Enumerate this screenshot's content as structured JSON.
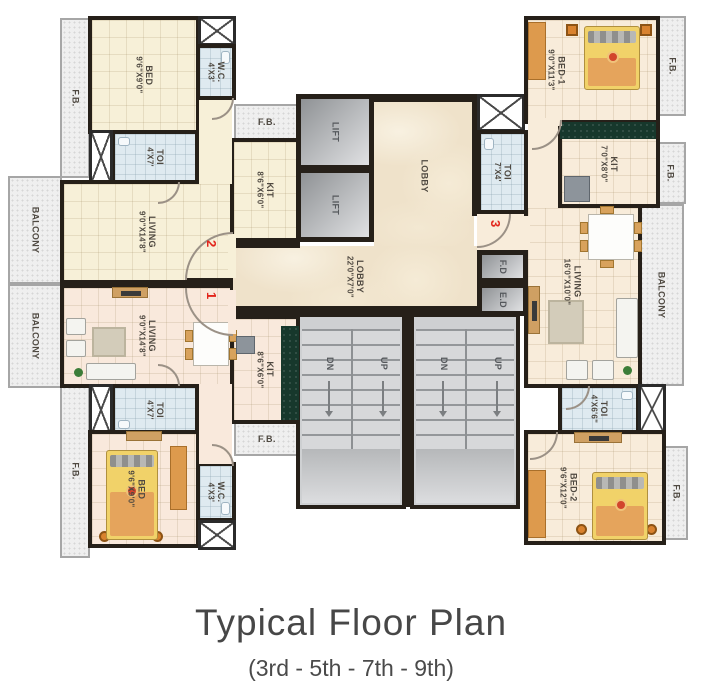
{
  "title": "Typical Floor Plan",
  "subtitle": "(3rd - 5th - 7th - 9th)",
  "fb_label": "F.B.",
  "stair": {
    "dn": "DN",
    "up": "UP"
  },
  "units": {
    "u1": "1",
    "u2": "2",
    "u3": "3"
  },
  "rooms": {
    "bed_tl": {
      "name": "BED",
      "dims": "9'6\"X9'0\""
    },
    "wc_tl": {
      "name": "W.C.",
      "dims": "4'X3'"
    },
    "toi_tl": {
      "name": "TOI",
      "dims": "4'X7'"
    },
    "kit_tl": {
      "name": "KIT",
      "dims": "8'6\"X6'0\""
    },
    "living_tl": {
      "name": "LIVING",
      "dims": "9'0\"X14'8\""
    },
    "balcony_t": {
      "name": "BALCONY"
    },
    "balcony_b": {
      "name": "BALCONY"
    },
    "living_bl": {
      "name": "LIVING",
      "dims": "9'0\"X14'8\""
    },
    "toi_bl": {
      "name": "TOI",
      "dims": "4'X7'"
    },
    "kit_bl": {
      "name": "KIT",
      "dims": "8'6\"X6'0\""
    },
    "bed_bl": {
      "name": "BED",
      "dims": "9'6\"X9'0\""
    },
    "wc_bl": {
      "name": "W.C.",
      "dims": "4'X3'"
    },
    "lift1": {
      "name": "LIFT"
    },
    "lift2": {
      "name": "LIFT"
    },
    "lobby_v": {
      "name": "LOBBY"
    },
    "lobby_h": {
      "name": "LOBBY",
      "dims": "22'0\"X7'0\""
    },
    "fd": {
      "name": "F.D"
    },
    "ed": {
      "name": "E.D"
    },
    "bed1_r": {
      "name": "BED-1",
      "dims": "9'0\"X11'3\""
    },
    "kit_r": {
      "name": "KIT",
      "dims": "7'0\"X8'0\""
    },
    "toi_r1": {
      "name": "TOI",
      "dims": "7'X4'"
    },
    "living_r": {
      "name": "LIVING",
      "dims": "16'0\"X10'0\""
    },
    "balcony_r": {
      "name": "BALCONY"
    },
    "toi_r2": {
      "name": "TOI",
      "dims": "4'X6'6\""
    },
    "bed2_r": {
      "name": "BED-2",
      "dims": "9'6\"X12'0\""
    }
  },
  "colors": {
    "wall": "#262019",
    "flat2_floor": "#f7f0d8",
    "flat1_floor": "#f9e9dc",
    "flat3_floor": "#f8ecda",
    "toilet_floor": "#dfeaf0",
    "lobby_marble": "#efe2ca",
    "stair_gray": "#ced0d2",
    "balcony_gray": "#efefef",
    "furniture_orange": "#d9822e",
    "bed_yellow": "#f1d269",
    "unit_number_red": "#e2251b"
  }
}
